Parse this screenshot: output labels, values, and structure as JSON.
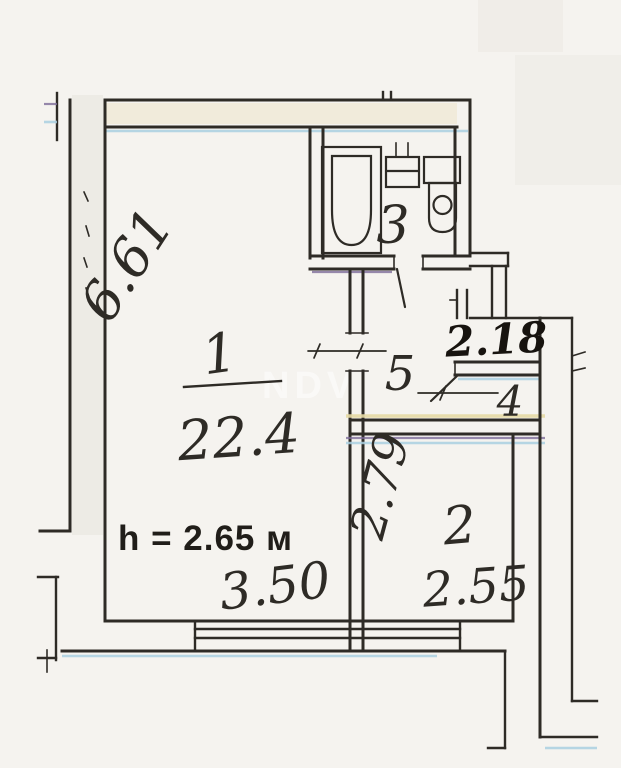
{
  "plan": {
    "document_kind": "apartment floor plan (scanned)",
    "watermark": "NDV",
    "ceiling_height": "h = 2.65 м",
    "rooms": [
      {
        "number": "1",
        "area": "22.4"
      },
      {
        "number": "2"
      },
      {
        "number": "3"
      },
      {
        "number": "4"
      },
      {
        "number": "5"
      }
    ],
    "dimensions": {
      "left_height": "6.61",
      "room1_width": "3.50",
      "room2_width": "2.55",
      "room2_depth": "2.79",
      "entry_width": "2.18"
    },
    "colors": {
      "paper": "#f5f3ef",
      "ink": "#2e2b26",
      "cyan": "#a9cfe0",
      "yellow": "#e6d9a4",
      "purple": "#7d6b99"
    }
  }
}
